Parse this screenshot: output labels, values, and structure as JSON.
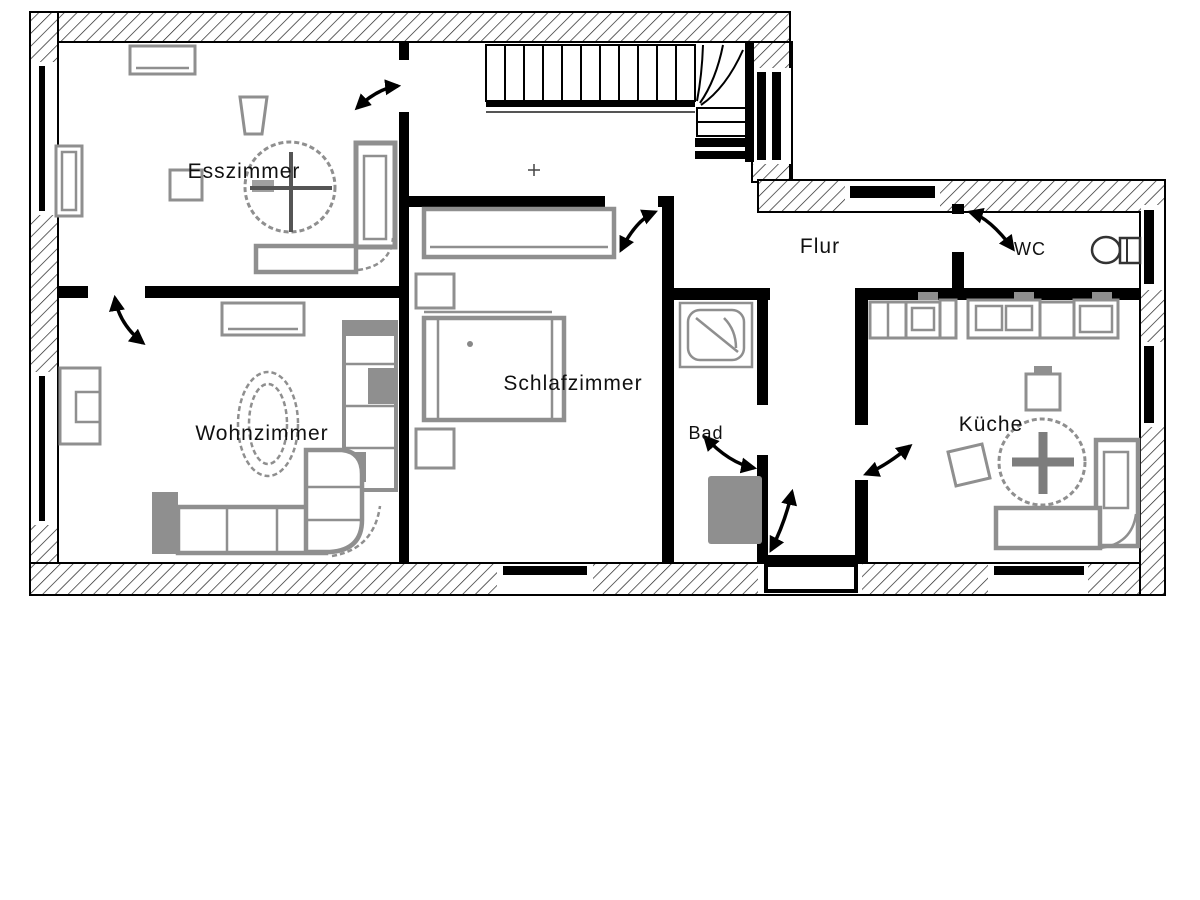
{
  "plan": {
    "type": "floor-plan",
    "rooms": [
      {
        "id": "esszimmer",
        "label": "Esszimmer"
      },
      {
        "id": "wohnzimmer",
        "label": "Wohnzimmer"
      },
      {
        "id": "schlafzimmer",
        "label": "Schlafzimmer"
      },
      {
        "id": "flur",
        "label": "Flur"
      },
      {
        "id": "wc",
        "label": "WC"
      },
      {
        "id": "bad",
        "label": "Bad"
      },
      {
        "id": "kueche",
        "label": "Küche"
      }
    ]
  },
  "colors": {
    "wall": "#000000",
    "furniture": "#8f8f8f",
    "label": "#111111",
    "background": "#ffffff"
  }
}
